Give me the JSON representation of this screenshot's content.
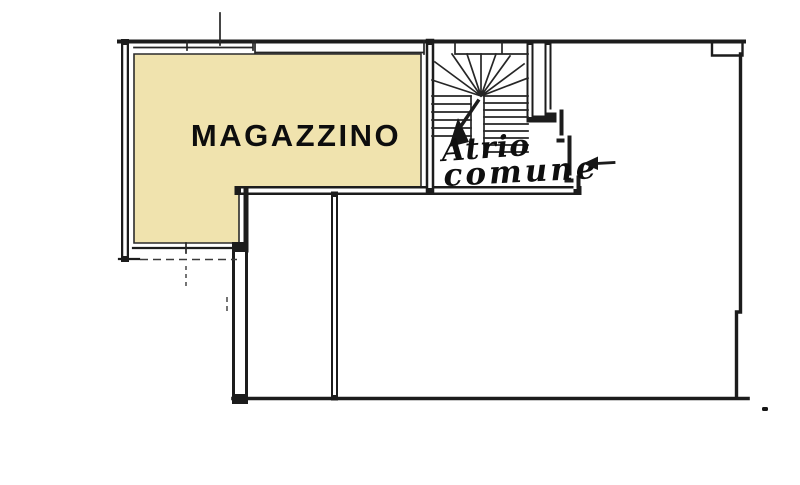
{
  "floorplan": {
    "background_color": "#ffffff",
    "wall_color": "#1c1c1c",
    "rooms": {
      "magazzino": {
        "label": "MAGAZZINO",
        "fill": "#f0e3ae",
        "highlighted": true
      },
      "atrio": {
        "label_line1": "Atrio",
        "label_line2": "comune"
      }
    },
    "icons": {
      "entrance_arrow_glyph": "←",
      "stair_direction_arrow_glyph": "▼"
    }
  }
}
